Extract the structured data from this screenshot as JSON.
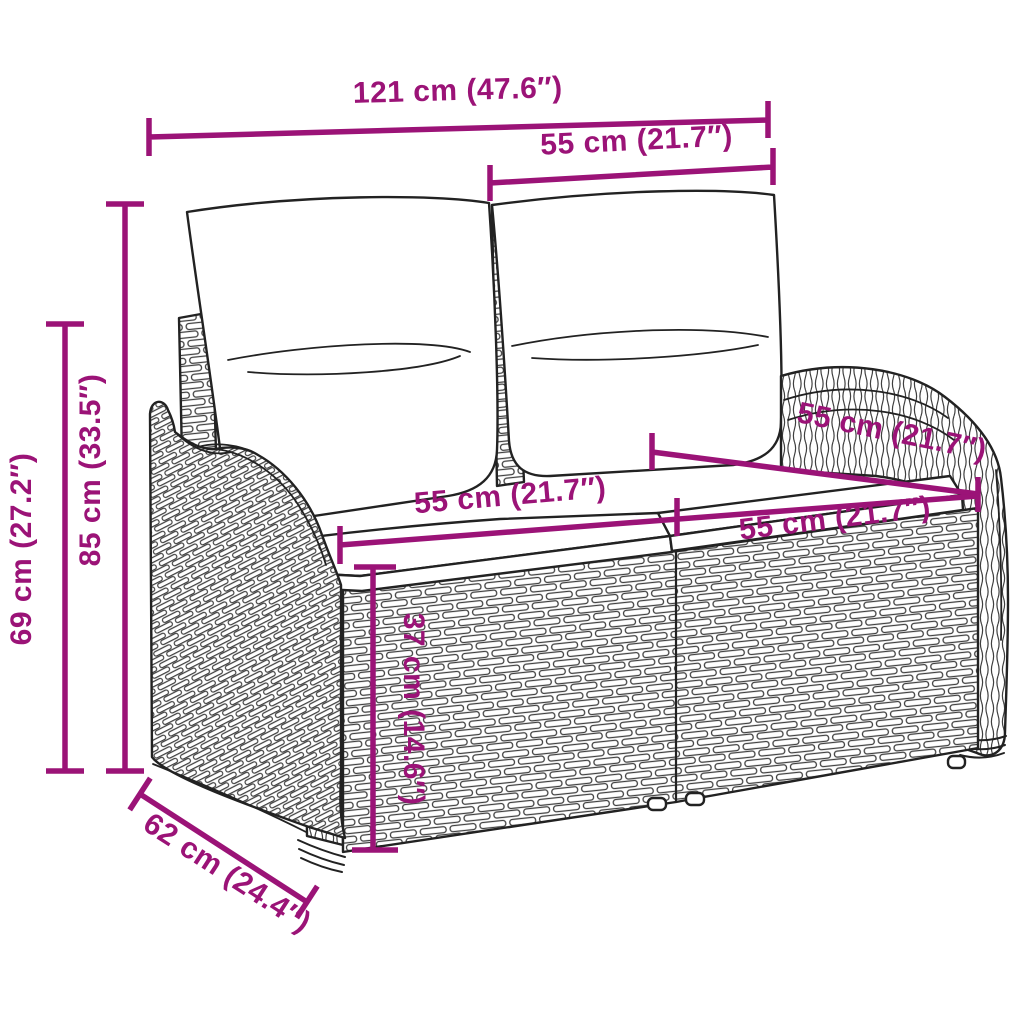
{
  "diagram": {
    "subject": "poly rattan two-seater garden bench with back and seat cushions",
    "style": "technical product line drawing with dimension annotations",
    "colors": {
      "dimension_annotation": "#9B1377",
      "line_art": "#222222",
      "wicker_shading": "#3F3F3F",
      "background": "#FFFFFF"
    },
    "dimensions": [
      {
        "id": "overall-width",
        "label": "121 cm (47.6″)"
      },
      {
        "id": "back-cushion-width",
        "label": "55 cm (21.7″)"
      },
      {
        "id": "total-height",
        "label": "85 cm (33.5″)"
      },
      {
        "id": "armrest-height",
        "label": "69 cm (27.2″)"
      },
      {
        "id": "seat-depth",
        "label": "55 cm (21.7″)"
      },
      {
        "id": "seat-width-left",
        "label": "55 cm (21.7″)"
      },
      {
        "id": "seat-width-right",
        "label": "55 cm (21.7″)"
      },
      {
        "id": "seat-height",
        "label": "37 cm (14.6″)"
      },
      {
        "id": "overall-depth",
        "label": "62 cm (24.4″)"
      }
    ]
  }
}
